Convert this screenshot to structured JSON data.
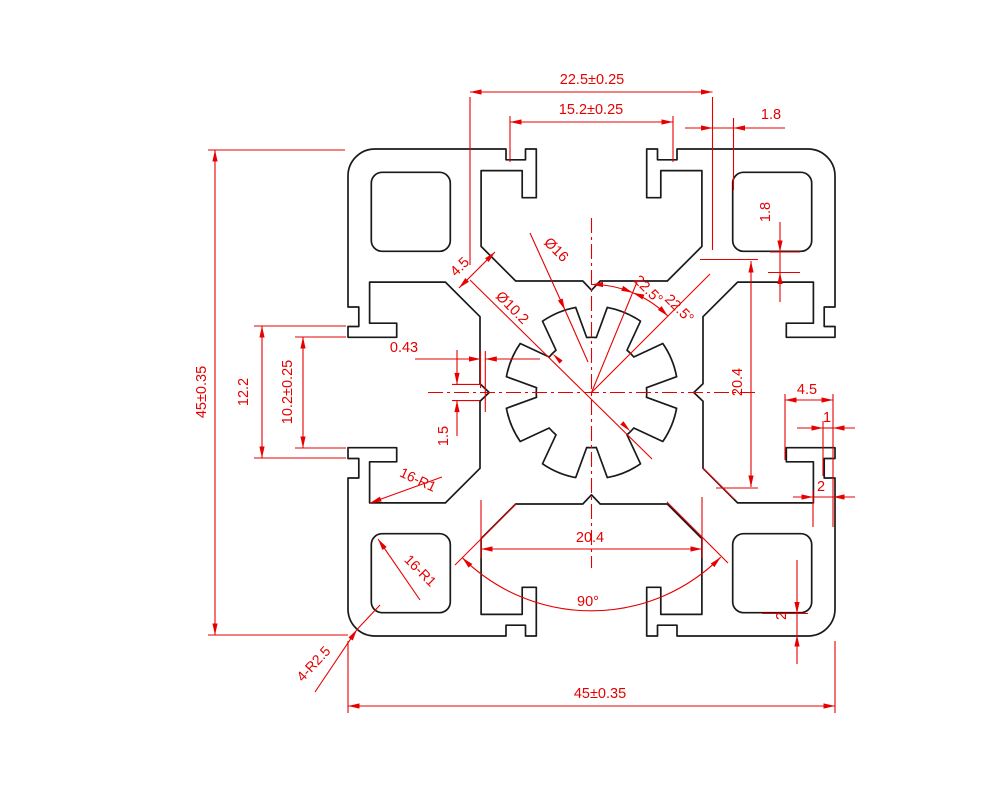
{
  "drawing": {
    "type": "technical-drawing",
    "subject": "45x45 aluminium extrusion profile cross-section",
    "colors": {
      "outline": "#1a1a1a",
      "dimension": "#e60000",
      "background": "#ffffff"
    },
    "dimensions": {
      "top_width": "22.5±0.25",
      "top_inner": "15.2±0.25",
      "top_wall": "1.8",
      "left_height": "45±0.35",
      "left_slot_outer": "12.2",
      "left_slot_opening": "10.2±0.25",
      "bottom_width": "45±0.35",
      "bottom_chamber_width": "20.4",
      "bottom_angle": "90°",
      "right_chamber_height": "20.4",
      "right_wall": "1.8",
      "right_lip_depth": "4.5",
      "right_groove_depth": "1",
      "right_wall_thickness": "2",
      "bottom_wall_thickness": "2",
      "center_offset": "0.43",
      "center_notch": "1.5",
      "web_width": "4.5",
      "bore_outer": "Ø16",
      "bore_inner": "Ø10.2",
      "angle_first": "22.5°",
      "angle_second": "22.5°",
      "fillet_slot": "16-R1",
      "fillet_hole": "16-R1",
      "fillet_corner": "4-R2.5"
    }
  }
}
